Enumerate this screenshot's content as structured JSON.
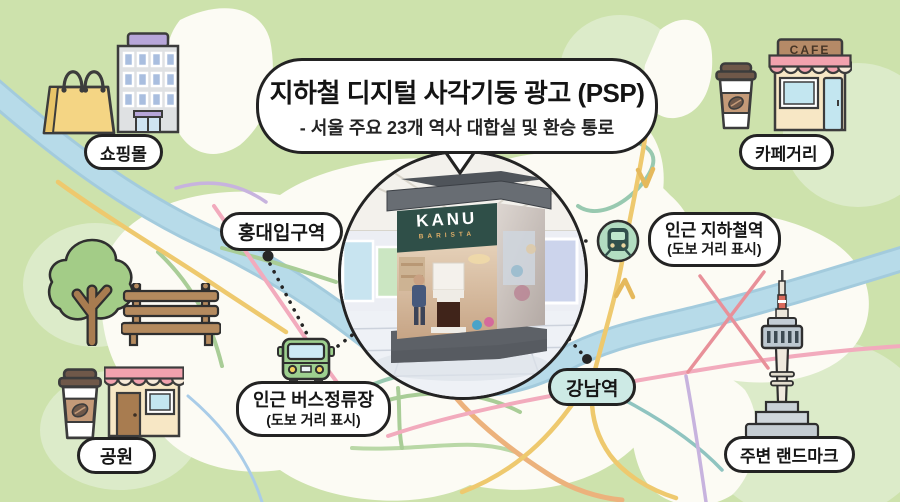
{
  "title": {
    "main": "지하철 디지털 사각기둥 광고 (PSP)",
    "subtitle": "- 서울 주요 23개 역사 대합실 및 환승 통로"
  },
  "labels": {
    "shopping_mall": "쇼핑몰",
    "cafe_street": "카페거리",
    "hongdae_station": "홍대입구역",
    "gangnam_station": "강남역",
    "park": "공원",
    "landmark": "주변 랜드마크"
  },
  "callouts": {
    "subway": {
      "line1": "인근 지하철역",
      "line2": "(도보 거리 표시)"
    },
    "bus": {
      "line1": "인근 버스정류장",
      "line2": "(도보 거리 표시)"
    }
  },
  "signs": {
    "cafe": "CAFE"
  },
  "pillar_ad": {
    "brand": "KANU",
    "subbrand": "BARISTA"
  },
  "colors": {
    "map_green": "#cde2ac",
    "map_green_light": "#dcebc9",
    "land_white": "#fcfbf4",
    "river_blue": "#b7dbe9",
    "road_yellow": "#eec96e",
    "road_pink": "#f2abbd",
    "road_teal": "#98c9b0",
    "road_purple": "#c7b3de",
    "road_orange": "#ecb27c",
    "gangnam_pill_bg": "#cdeae5",
    "outline_dark": "#232323",
    "ad_header_teal": "#2f4f48",
    "bus_green": "#9ed08f",
    "train_circle_green": "#b2ddc1"
  }
}
